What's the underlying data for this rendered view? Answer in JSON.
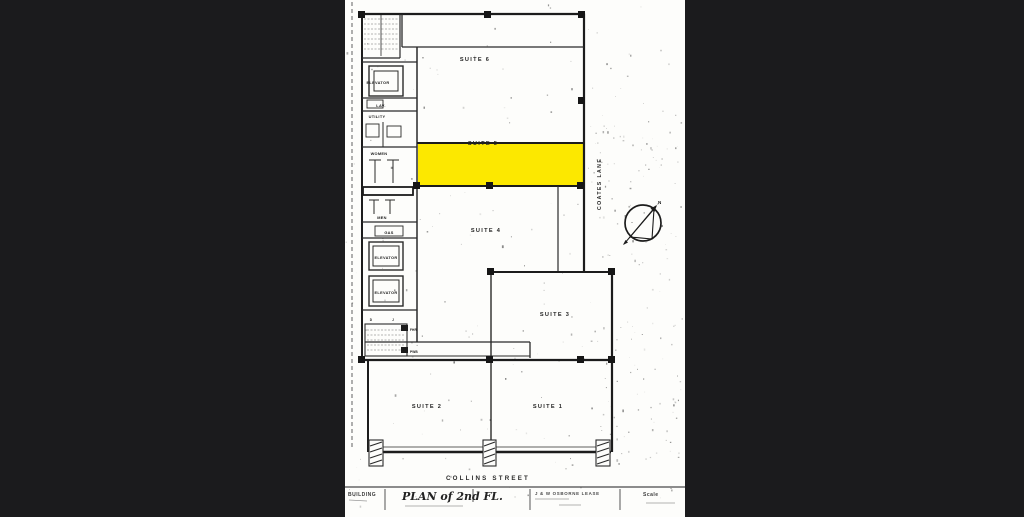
{
  "window": {
    "background": "#1b1b1d",
    "paper_color": "#fdfdfb"
  },
  "plan": {
    "suite_labels": [
      {
        "label": "SUITE 6"
      },
      {
        "label": "SUITE 5"
      },
      {
        "label": "SUITE 4"
      },
      {
        "label": "SUITE 3"
      },
      {
        "label": "SUITE 2"
      },
      {
        "label": "SUITE 1"
      }
    ],
    "highlight": {
      "suite": "SUITE 5",
      "color": "#fce800"
    },
    "core_rooms": {
      "elevator_top": "ELEVATOR",
      "lav": "LAV.",
      "utility": "UTILITY",
      "women": "WOMEN",
      "men": "MEN",
      "gas": "GAS",
      "elevator_mid": "ELEVATOR",
      "elevator_low": "ELEVATOR",
      "door_d": "D",
      "door_j": "J",
      "fhr": "FHR",
      "pwb": "PWB"
    },
    "streets": {
      "front": "COLLINS STREET",
      "side": "COATES LANE"
    },
    "compass": {
      "label": "N"
    }
  },
  "title_block": {
    "building_label": "BUILDING",
    "plan_title": "PLAN of 2nd FL.",
    "client": "J & W OSBORNE LEASE",
    "scale_label": "Scale"
  }
}
